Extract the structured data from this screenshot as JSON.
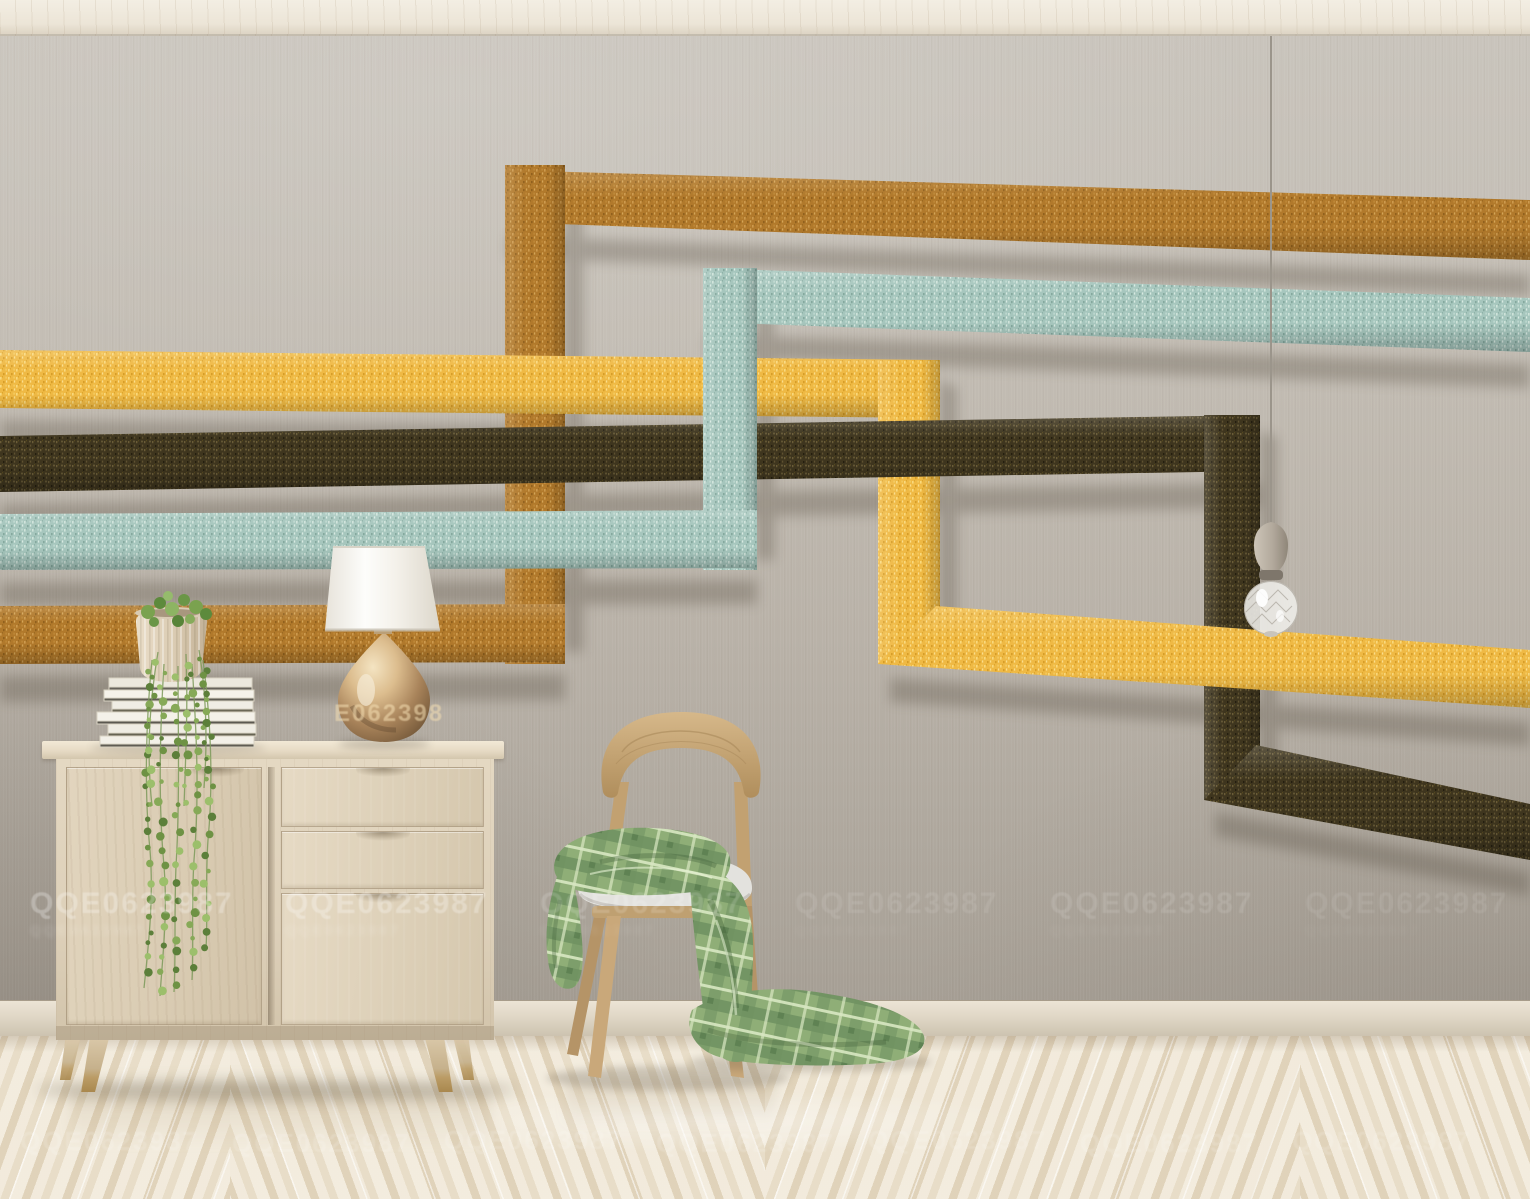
{
  "scene": {
    "description": "Bright interior room: gray textured wall with a mural of four interlocking rectangular fabric strips (caramel, golden yellow, teal and dark brown), a light ash sideboard topped with a stack of white books, a trailing string-of-pearls plant in a cream pot and a gold teardrop table lamp with white shade, a natural wood chair with a gray cushion draped with a green plaid throw, a single pendant crystal bulb on a cord, cream baseboard and glossy chevron parquet floor with repeated watermark stamps."
  },
  "watermarks": {
    "id_text": "QQE0623987",
    "lamp_fragment": "E062398"
  },
  "palette": {
    "wall": "#bdb7ae",
    "ceiling": "#efe9dc",
    "floor": "#ece3d1",
    "baseboard": "#ddd4c3",
    "caramel": "#b1792b",
    "yellow": "#efb944",
    "teal": "#a6c6bd",
    "brown": "#3e351e",
    "cabinet_wood": "#ddd0b9",
    "chair_wood": "#c8a672",
    "blanket_green": "#8fae77",
    "lamp_gold": "#b28d5e",
    "lamp_shade": "#f7f5f1",
    "cushion": "#e3e2de",
    "bulb_socket": "#b9b0a3"
  }
}
